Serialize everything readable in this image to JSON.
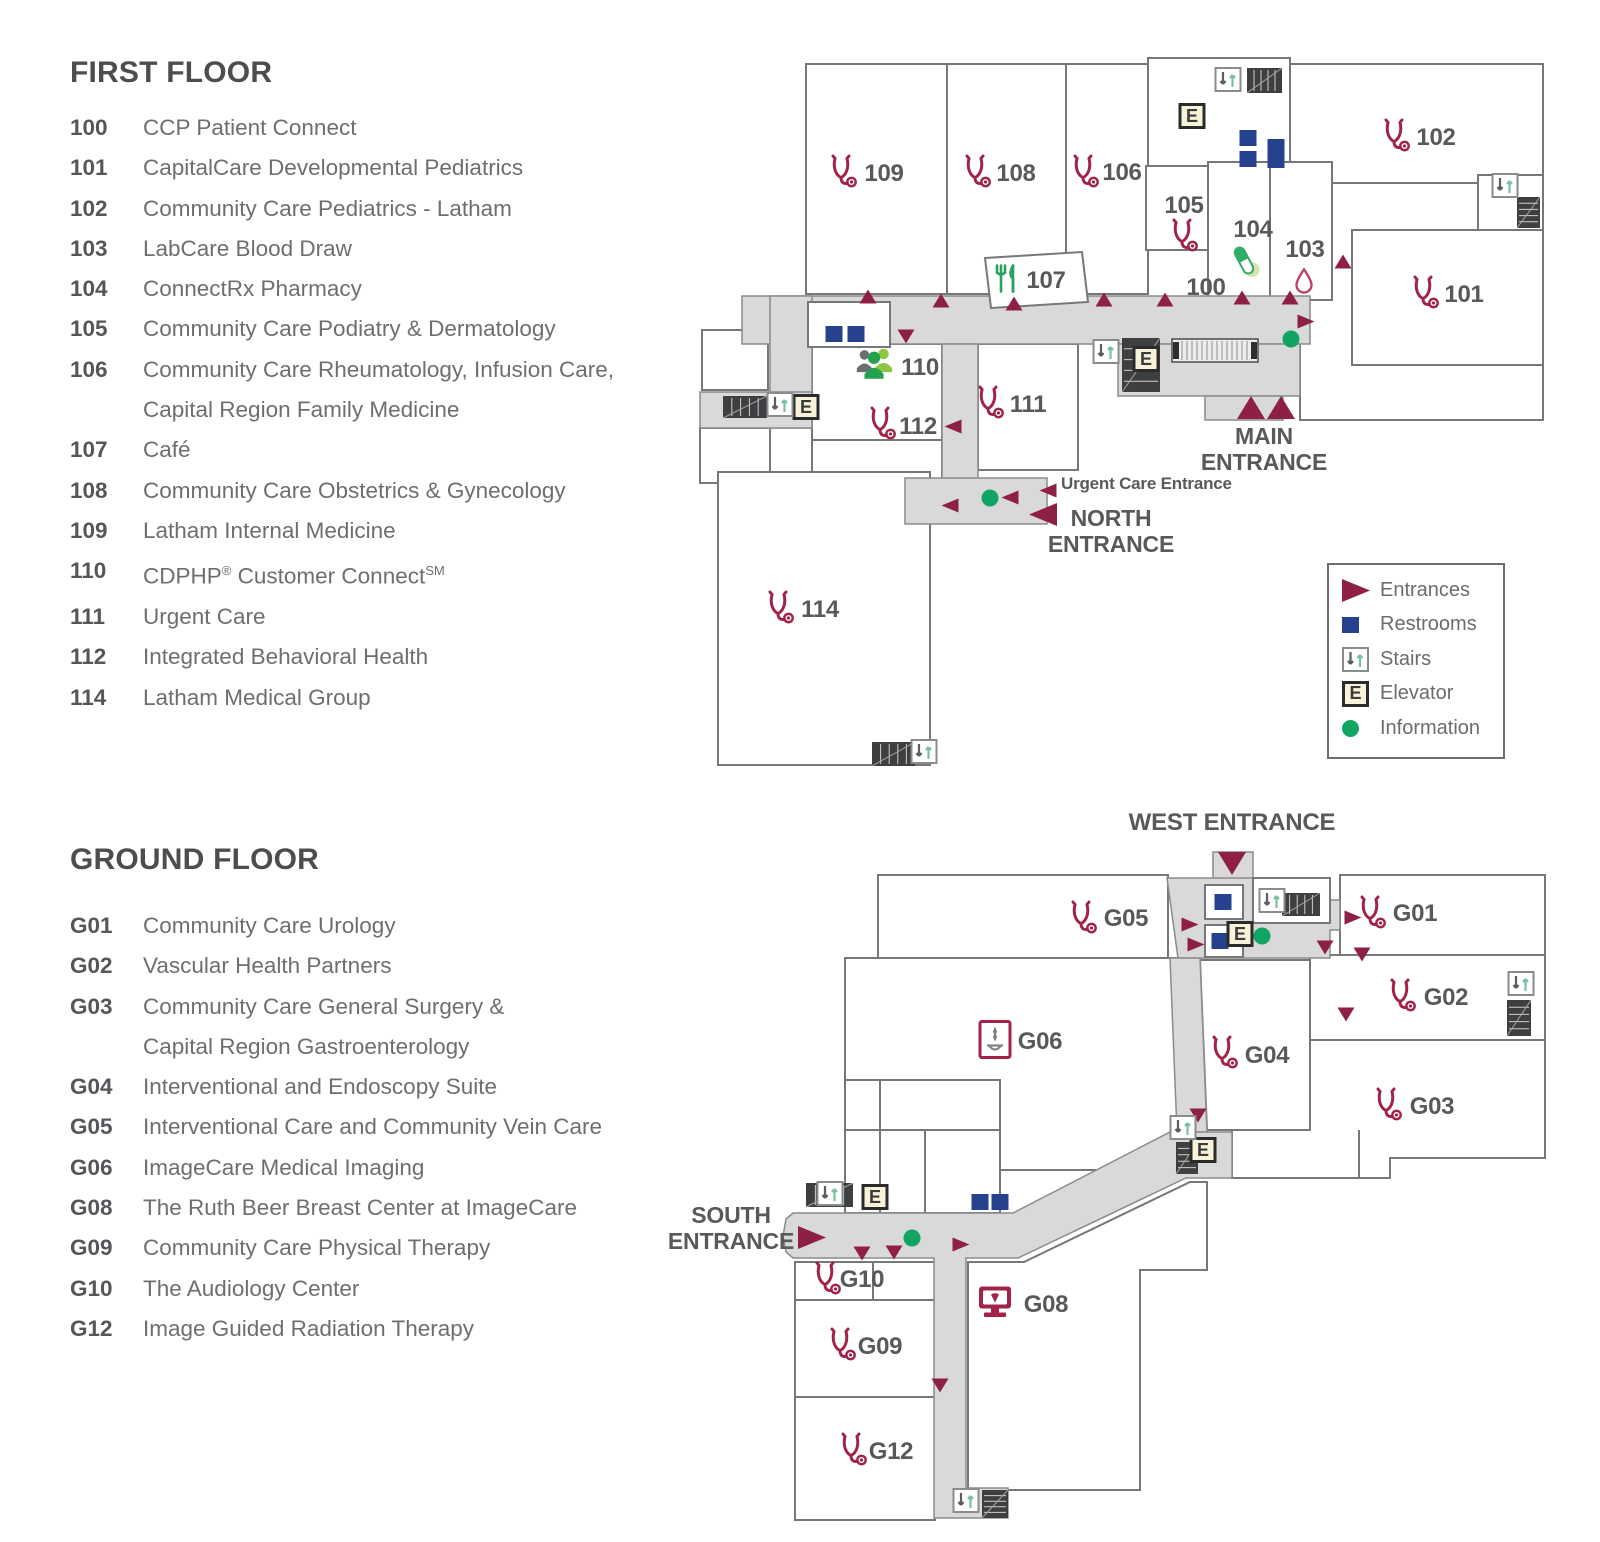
{
  "colors": {
    "entrance": "#8e2045",
    "stethoscope": "#a12347",
    "restroom": "#26418e",
    "information": "#12a463",
    "elevator_bg": "#f8f2d8",
    "label_text": "#58595b",
    "wall": "#76777a",
    "corridor": "#d9d9da",
    "cafe_green": "#2aa25f",
    "people_green": "#23a14e",
    "people_light_green": "#8dc63f",
    "people_grey": "#6d6e71",
    "pill_green": "#2fae67",
    "blood_drop": "#b64666",
    "imaging_grey": "#808285",
    "dark_block": "#3e3f41"
  },
  "legend": {
    "items": [
      {
        "icon": "entrance",
        "label": "Entrances"
      },
      {
        "icon": "restroom",
        "label": "Restrooms"
      },
      {
        "icon": "stairs",
        "label": "Stairs"
      },
      {
        "icon": "elevator",
        "label": "Elevator"
      },
      {
        "icon": "info",
        "label": "Information"
      }
    ]
  },
  "first_floor": {
    "title": "FIRST FLOOR",
    "directory": [
      {
        "num": "100",
        "lines": [
          "CCP Patient Connect"
        ]
      },
      {
        "num": "101",
        "lines": [
          "CapitalCare Developmental Pediatrics"
        ]
      },
      {
        "num": "102",
        "lines": [
          "Community Care Pediatrics - Latham"
        ]
      },
      {
        "num": "103",
        "lines": [
          "LabCare Blood Draw"
        ]
      },
      {
        "num": "104",
        "lines": [
          "ConnectRx Pharmacy"
        ]
      },
      {
        "num": "105",
        "lines": [
          "Community Care Podiatry & Dermatology"
        ]
      },
      {
        "num": "106",
        "lines": [
          "Community Care Rheumatology, Infusion Care,",
          "Capital Region Family Medicine"
        ]
      },
      {
        "num": "107",
        "lines": [
          "Café"
        ]
      },
      {
        "num": "108",
        "lines": [
          "Community Care Obstetrics & Gynecology"
        ]
      },
      {
        "num": "109",
        "lines": [
          "Latham Internal Medicine"
        ]
      },
      {
        "num": "110",
        "lines": [
          "CDPHP® Customer Connect℠"
        ]
      },
      {
        "num": "111",
        "lines": [
          "Urgent Care"
        ]
      },
      {
        "num": "112",
        "lines": [
          "Integrated Behavioral Health"
        ]
      },
      {
        "num": "114",
        "lines": [
          "Latham Medical Group"
        ]
      }
    ],
    "map": {
      "rooms": [
        {
          "id": "109",
          "icon": "steth",
          "ix": 843,
          "iy": 174,
          "label": "109",
          "lx": 884,
          "ly": 174
        },
        {
          "id": "108",
          "icon": "steth",
          "ix": 977,
          "iy": 174,
          "label": "108",
          "lx": 1016,
          "ly": 174
        },
        {
          "id": "106",
          "icon": "steth",
          "ix": 1085,
          "iy": 174,
          "label": "106",
          "lx": 1122,
          "ly": 173
        },
        {
          "id": "102",
          "icon": "steth",
          "ix": 1396,
          "iy": 138,
          "label": "102",
          "lx": 1436,
          "ly": 138
        },
        {
          "id": "101",
          "icon": "steth",
          "ix": 1425,
          "iy": 295,
          "label": "101",
          "lx": 1464,
          "ly": 295
        },
        {
          "id": "105",
          "icon": "steth",
          "ix": 1184,
          "iy": 238,
          "label": "105",
          "lx": 1184,
          "ly": 206
        },
        {
          "id": "104",
          "icon": "pill",
          "ix": 1246,
          "iy": 264,
          "label": "104",
          "lx": 1253,
          "ly": 230
        },
        {
          "id": "103",
          "icon": "drop",
          "ix": 1304,
          "iy": 284,
          "label": "103",
          "lx": 1305,
          "ly": 250
        },
        {
          "id": "100",
          "icon": "",
          "ix": 0,
          "iy": 0,
          "label": "100",
          "lx": 1206,
          "ly": 288
        },
        {
          "id": "107",
          "icon": "food",
          "ix": 1007,
          "iy": 281,
          "label": "107",
          "lx": 1046,
          "ly": 281
        },
        {
          "id": "110",
          "icon": "people",
          "ix": 874,
          "iy": 366,
          "label": "110",
          "lx": 920,
          "ly": 368
        },
        {
          "id": "111",
          "icon": "steth",
          "ix": 990,
          "iy": 405,
          "label": "111",
          "lx": 1028,
          "ly": 405
        },
        {
          "id": "112",
          "icon": "steth",
          "ix": 882,
          "iy": 426,
          "label": "112",
          "lx": 918,
          "ly": 427
        },
        {
          "id": "114",
          "icon": "steth",
          "ix": 780,
          "iy": 610,
          "label": "114",
          "lx": 820,
          "ly": 610
        }
      ],
      "entrances": [
        {
          "d": "up",
          "s": "sm",
          "x": 868,
          "y": 299
        },
        {
          "d": "up",
          "s": "sm",
          "x": 941,
          "y": 303
        },
        {
          "d": "up",
          "s": "sm",
          "x": 1014,
          "y": 306
        },
        {
          "d": "up",
          "s": "sm",
          "x": 1104,
          "y": 302
        },
        {
          "d": "up",
          "s": "sm",
          "x": 1165,
          "y": 302
        },
        {
          "d": "up",
          "s": "sm",
          "x": 1242,
          "y": 300
        },
        {
          "d": "up",
          "s": "sm",
          "x": 1290,
          "y": 300
        },
        {
          "d": "up",
          "s": "sm",
          "x": 1343,
          "y": 264
        },
        {
          "d": "down",
          "s": "sm",
          "x": 906,
          "y": 339
        },
        {
          "d": "right",
          "s": "sm",
          "x": 1306,
          "y": 324
        },
        {
          "d": "left",
          "s": "sm",
          "x": 953,
          "y": 429
        },
        {
          "d": "left",
          "s": "sm",
          "x": 950,
          "y": 508
        },
        {
          "d": "left",
          "s": "sm",
          "x": 1010,
          "y": 500
        },
        {
          "d": "left",
          "s": "sm",
          "x": 1048,
          "y": 493
        },
        {
          "d": "left",
          "s": "lg",
          "x": 1043,
          "y": 517
        },
        {
          "d": "up",
          "s": "lg",
          "x": 1251,
          "y": 410
        },
        {
          "d": "up",
          "s": "lg",
          "x": 1281,
          "y": 410
        }
      ],
      "amenities": [
        {
          "t": "restroom",
          "x": 834,
          "y": 334
        },
        {
          "t": "restroom",
          "x": 856,
          "y": 334
        },
        {
          "t": "restroom",
          "x": 1248,
          "y": 138
        },
        {
          "t": "restroom",
          "x": 1248,
          "y": 159
        },
        {
          "t": "restroom",
          "x": 1276,
          "y": 147
        },
        {
          "t": "restroom",
          "x": 1276,
          "y": 160
        },
        {
          "t": "elevator",
          "x": 806,
          "y": 407
        },
        {
          "t": "elevator",
          "x": 1192,
          "y": 116
        },
        {
          "t": "elevator",
          "x": 1146,
          "y": 359
        },
        {
          "t": "stairs",
          "x": 780,
          "y": 407
        },
        {
          "t": "stairs",
          "x": 1228,
          "y": 82
        },
        {
          "t": "stairs",
          "x": 1106,
          "y": 354
        },
        {
          "t": "stairs",
          "x": 1505,
          "y": 188
        },
        {
          "t": "stairs",
          "x": 924,
          "y": 754
        },
        {
          "t": "info",
          "x": 990,
          "y": 498
        },
        {
          "t": "info",
          "x": 1291,
          "y": 339
        }
      ],
      "labels": [
        {
          "id": "main-entrance",
          "lines": [
            "MAIN",
            "ENTRANCE"
          ],
          "x": 1264,
          "y": 424,
          "size": 23,
          "anchor": "center"
        },
        {
          "id": "north-entrance",
          "lines": [
            "NORTH",
            "ENTRANCE"
          ],
          "x": 1111,
          "y": 506,
          "size": 23,
          "anchor": "center"
        },
        {
          "id": "urgent-care-entrance",
          "lines": [
            "Urgent Care Entrance"
          ],
          "x": 1061,
          "y": 474,
          "size": 17,
          "anchor": "left"
        }
      ]
    }
  },
  "ground_floor": {
    "title": "GROUND FLOOR",
    "directory": [
      {
        "num": "G01",
        "lines": [
          "Community Care Urology"
        ]
      },
      {
        "num": "G02",
        "lines": [
          "Vascular Health Partners"
        ]
      },
      {
        "num": "G03",
        "lines": [
          "Community Care General Surgery &",
          "Capital Region Gastroenterology"
        ]
      },
      {
        "num": "G04",
        "lines": [
          "Interventional and Endoscopy Suite"
        ]
      },
      {
        "num": "G05",
        "lines": [
          "Interventional Care and Community Vein Care"
        ]
      },
      {
        "num": "G06",
        "lines": [
          "ImageCare Medical Imaging"
        ]
      },
      {
        "num": "G08",
        "lines": [
          "The Ruth Beer Breast Center at ImageCare"
        ]
      },
      {
        "num": "G09",
        "lines": [
          "Community Care Physical Therapy"
        ]
      },
      {
        "num": "G10",
        "lines": [
          "The Audiology Center"
        ]
      },
      {
        "num": "G12",
        "lines": [
          "Image Guided Radiation Therapy"
        ]
      }
    ],
    "map": {
      "rooms": [
        {
          "id": "G05",
          "icon": "steth",
          "ix": 1083,
          "iy": 920,
          "label": "G05",
          "lx": 1126,
          "ly": 919
        },
        {
          "id": "G01",
          "icon": "steth",
          "ix": 1372,
          "iy": 915,
          "label": "G01",
          "lx": 1415,
          "ly": 914
        },
        {
          "id": "G02",
          "icon": "steth",
          "ix": 1402,
          "iy": 998,
          "label": "G02",
          "lx": 1446,
          "ly": 998
        },
        {
          "id": "G04",
          "icon": "steth",
          "ix": 1224,
          "iy": 1055,
          "label": "G04",
          "lx": 1267,
          "ly": 1056
        },
        {
          "id": "G03",
          "icon": "steth",
          "ix": 1388,
          "iy": 1107,
          "label": "G03",
          "lx": 1432,
          "ly": 1107
        },
        {
          "id": "G06",
          "icon": "imaging",
          "ix": 995,
          "iy": 1042,
          "label": "G06",
          "lx": 1040,
          "ly": 1042
        },
        {
          "id": "G10",
          "icon": "steth",
          "ix": 827,
          "iy": 1281,
          "label": "G10",
          "lx": 862,
          "ly": 1280
        },
        {
          "id": "G09",
          "icon": "steth",
          "ix": 842,
          "iy": 1347,
          "label": "G09",
          "lx": 880,
          "ly": 1347
        },
        {
          "id": "G12",
          "icon": "steth",
          "ix": 853,
          "iy": 1452,
          "label": "G12",
          "lx": 891,
          "ly": 1452
        },
        {
          "id": "G08",
          "icon": "ultrasound",
          "ix": 995,
          "iy": 1305,
          "label": "G08",
          "lx": 1046,
          "ly": 1305
        }
      ],
      "entrances": [
        {
          "d": "down",
          "s": "lg",
          "x": 1232,
          "y": 866
        },
        {
          "d": "right",
          "s": "lg",
          "x": 812,
          "y": 1240
        },
        {
          "d": "right",
          "s": "sm",
          "x": 1353,
          "y": 920
        },
        {
          "d": "right",
          "s": "sm",
          "x": 1190,
          "y": 927
        },
        {
          "d": "right",
          "s": "sm",
          "x": 1196,
          "y": 947
        },
        {
          "d": "right",
          "s": "sm",
          "x": 961,
          "y": 1247
        },
        {
          "d": "down",
          "s": "sm",
          "x": 1325,
          "y": 950
        },
        {
          "d": "down",
          "s": "sm",
          "x": 1362,
          "y": 957
        },
        {
          "d": "down",
          "s": "sm",
          "x": 1346,
          "y": 1017
        },
        {
          "d": "down",
          "s": "sm",
          "x": 1198,
          "y": 1118
        },
        {
          "d": "down",
          "s": "sm",
          "x": 862,
          "y": 1256
        },
        {
          "d": "down",
          "s": "sm",
          "x": 894,
          "y": 1255
        },
        {
          "d": "down",
          "s": "sm",
          "x": 940,
          "y": 1388
        }
      ],
      "amenities": [
        {
          "t": "restroom",
          "x": 1223,
          "y": 902
        },
        {
          "t": "restroom",
          "x": 1220,
          "y": 941
        },
        {
          "t": "restroom",
          "x": 980,
          "y": 1202
        },
        {
          "t": "restroom",
          "x": 1000,
          "y": 1202
        },
        {
          "t": "elevator",
          "x": 1240,
          "y": 934
        },
        {
          "t": "elevator",
          "x": 1203,
          "y": 1150
        },
        {
          "t": "elevator",
          "x": 875,
          "y": 1197
        },
        {
          "t": "stairs",
          "x": 1272,
          "y": 903
        },
        {
          "t": "stairs",
          "x": 1183,
          "y": 1130
        },
        {
          "t": "stairs",
          "x": 830,
          "y": 1196
        },
        {
          "t": "stairs",
          "x": 966,
          "y": 1503
        },
        {
          "t": "stairs",
          "x": 1521,
          "y": 986
        },
        {
          "t": "info",
          "x": 1262,
          "y": 936
        },
        {
          "t": "info",
          "x": 912,
          "y": 1238
        }
      ],
      "labels": [
        {
          "id": "west-entrance",
          "lines": [
            "WEST ENTRANCE"
          ],
          "x": 1232,
          "y": 810,
          "size": 24,
          "anchor": "center"
        },
        {
          "id": "south-entrance",
          "lines": [
            "SOUTH",
            "ENTRANCE"
          ],
          "x": 731,
          "y": 1203,
          "size": 23,
          "anchor": "center"
        }
      ]
    }
  }
}
